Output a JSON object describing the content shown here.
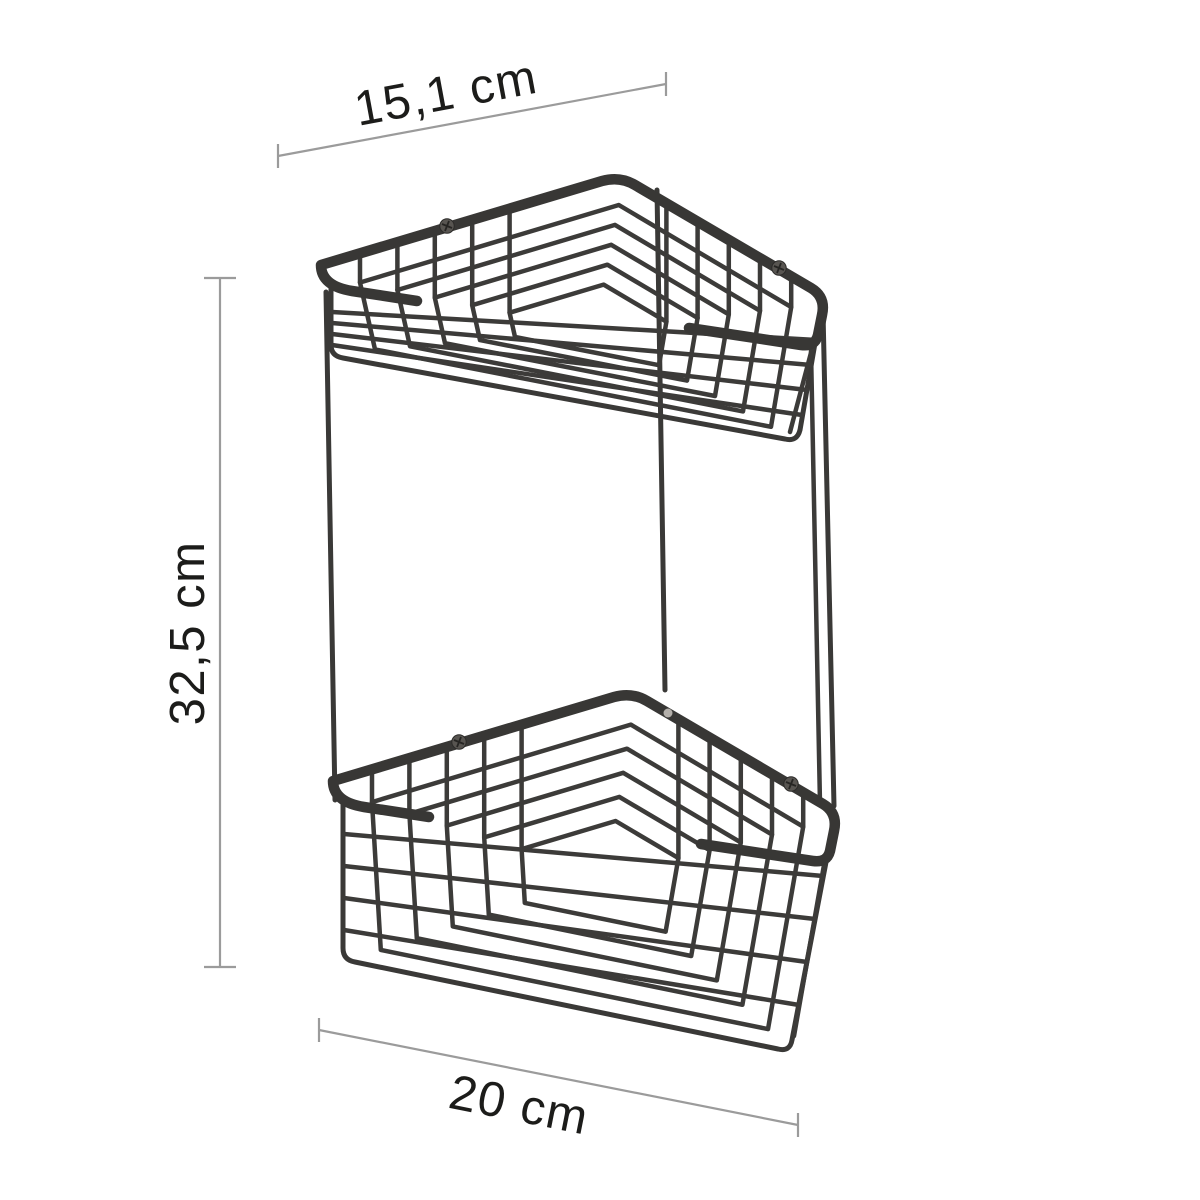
{
  "page": {
    "background_color": "#ffffff"
  },
  "diagram": {
    "subject": "two-tier corner wire shower basket",
    "tier_count": 2,
    "wire_color": "#3a3938",
    "dimension_line_color": "#9b9b9b",
    "label_color": "#1c1c1a"
  },
  "dimensions": {
    "width": {
      "label": "15,1 cm",
      "position": "top"
    },
    "height": {
      "label": "32,5 cm",
      "position": "left"
    },
    "depth": {
      "label": "20 cm",
      "position": "bottom"
    }
  },
  "screws": {
    "count": 4,
    "color": "#585551"
  }
}
